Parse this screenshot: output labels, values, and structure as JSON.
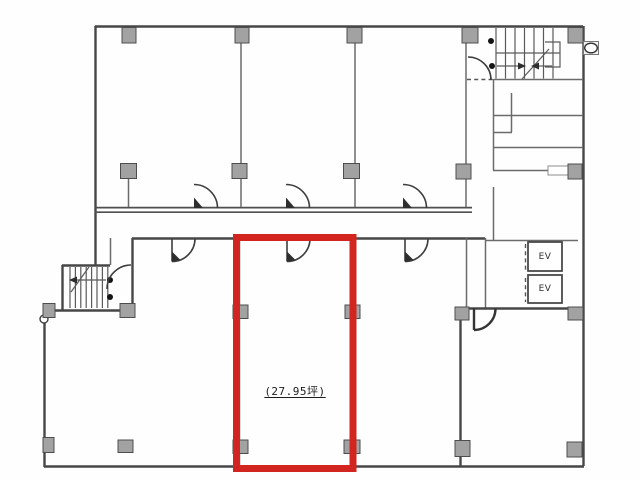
{
  "plan": {
    "area_label": "(27.95坪)",
    "elevators": [
      {
        "label": "EV"
      },
      {
        "label": "EV"
      }
    ],
    "colors": {
      "highlight": "#d3251f",
      "wall": "#474747",
      "column_fill": "#a2a2a2"
    }
  }
}
